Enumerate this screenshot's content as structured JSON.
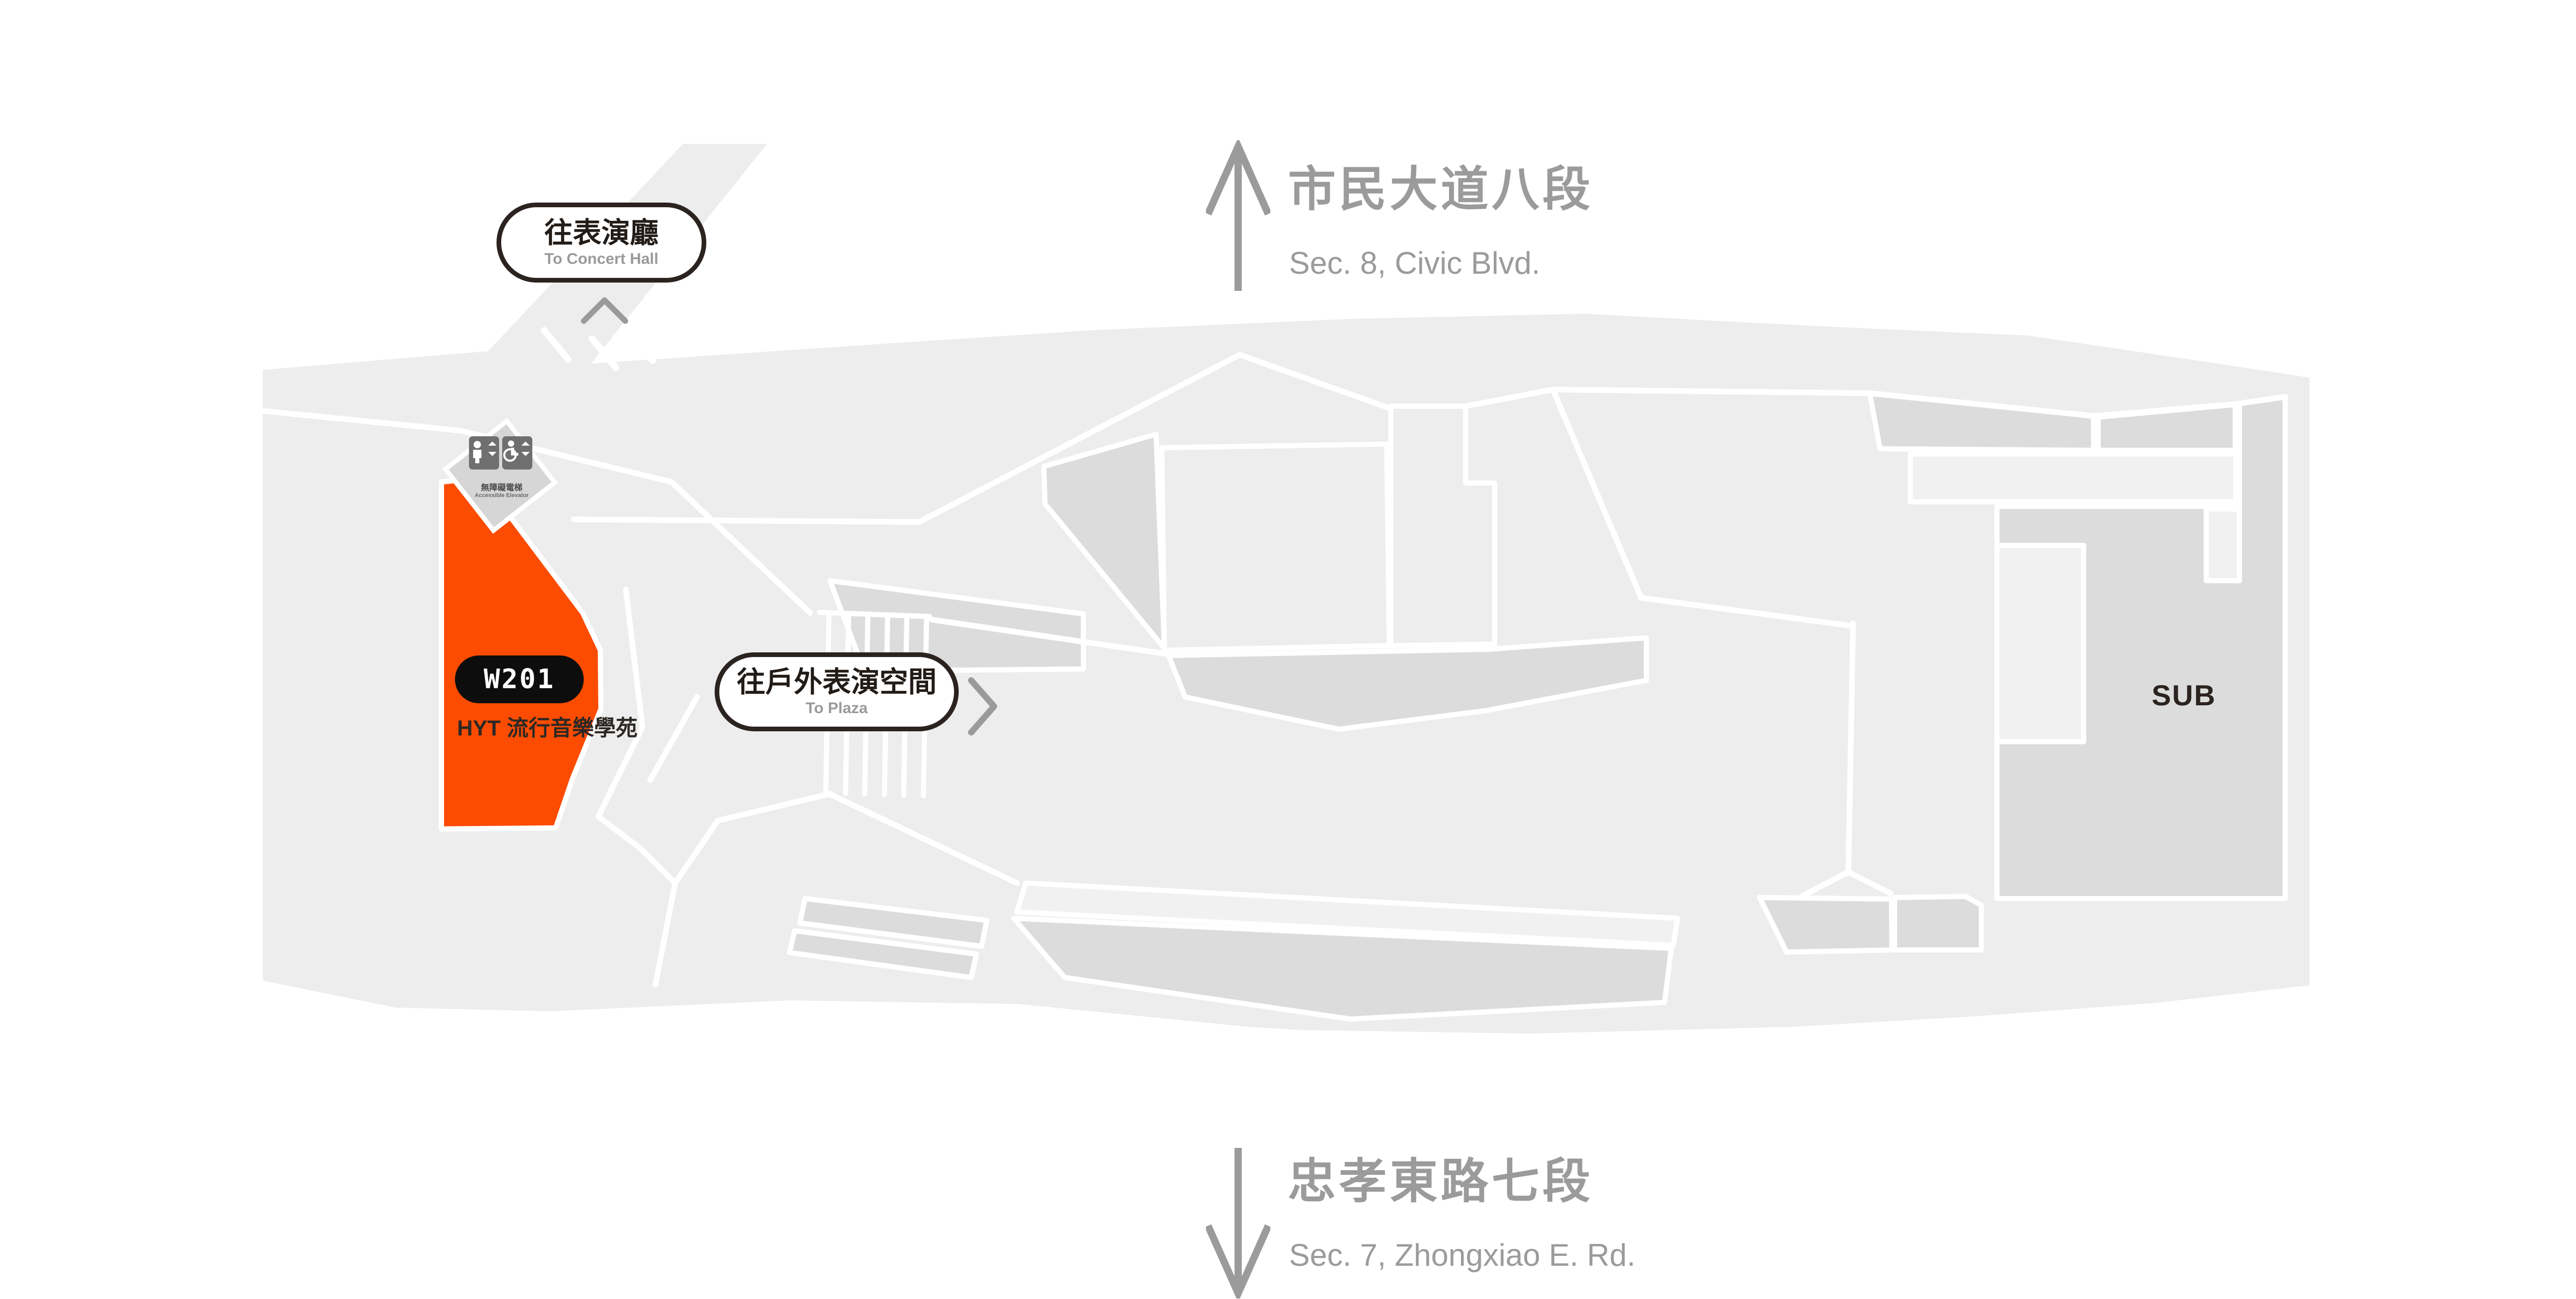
{
  "streets": {
    "top": {
      "zh": "市民大道八段",
      "en": "Sec. 8, Civic Blvd."
    },
    "bottom": {
      "zh": "忠孝東路七段",
      "en": "Sec. 7, Zhongxiao E. Rd."
    }
  },
  "wayfinding": {
    "to_concert_hall": {
      "zh": "往表演廳",
      "en": "To Concert Hall"
    },
    "to_plaza": {
      "zh": "往戶外表演空間",
      "en": "To Plaza"
    }
  },
  "room": {
    "code": "W201",
    "name": "HYT 流行音樂學苑"
  },
  "elevator": {
    "zh": "無障礙電梯",
    "en": "Accessible Elevator"
  },
  "areas": {
    "sub": "SUB"
  },
  "colors": {
    "highlight": "#fc4c02",
    "map_base": "#ededed",
    "map_room_dark": "#dcdcdc",
    "map_room_light": "#f1f1f1",
    "street_label": "#9b9b9b",
    "pill_border": "#2b2320",
    "room_pill_bg": "#0d0d0d"
  }
}
